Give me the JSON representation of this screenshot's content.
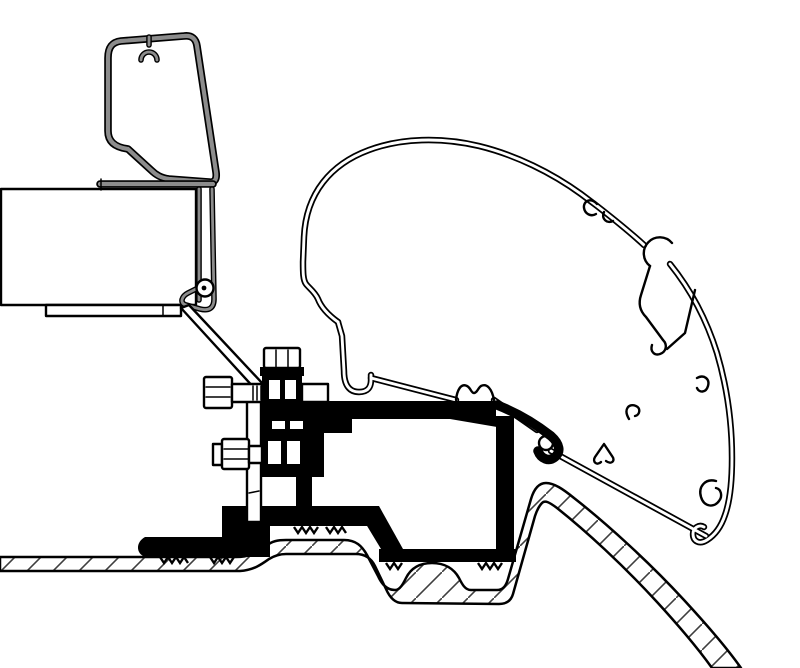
{
  "figure": {
    "kind": "technical-cross-section-line-drawing",
    "description": "Cross-section of an awning roof adapter: cassette profile (left, gray), bolted black adapter bracket (center), curved awning mounting rail profile (right), seated on a hatched vehicle-roof sheet section (bottom).",
    "canvas": {
      "width": 800,
      "height": 668
    }
  },
  "colors": {
    "background": "#ffffff",
    "ink": "#000000",
    "profile_gray": "#8c8c8c",
    "hatch": "#3f3f3f"
  },
  "components": [
    {
      "name": "awning-cassette",
      "render": "white box, black outline"
    },
    {
      "name": "cassette-cap-profile",
      "render": "gray hollow extrusion with c-clip"
    },
    {
      "name": "cassette-end-cap",
      "render": "gray channel with round fastener"
    },
    {
      "name": "mounting-plate",
      "render": "thin diagonal and vertical plate"
    },
    {
      "name": "adapter-bracket",
      "render": "solid black bracket with serrated feet"
    },
    {
      "name": "hex-bolt-vertical",
      "render": "hex head bolt, top"
    },
    {
      "name": "hex-bolt-upper",
      "render": "hex head bolt, horizontal"
    },
    {
      "name": "hex-bolt-lower",
      "render": "hex head bolt with washer, horizontal"
    },
    {
      "name": "awning-rail-profile",
      "render": "large curved hollow extrusion with c-clips and hooks"
    },
    {
      "name": "vehicle-roof-section",
      "render": "thin sheet band with diagonal hatching"
    }
  ]
}
